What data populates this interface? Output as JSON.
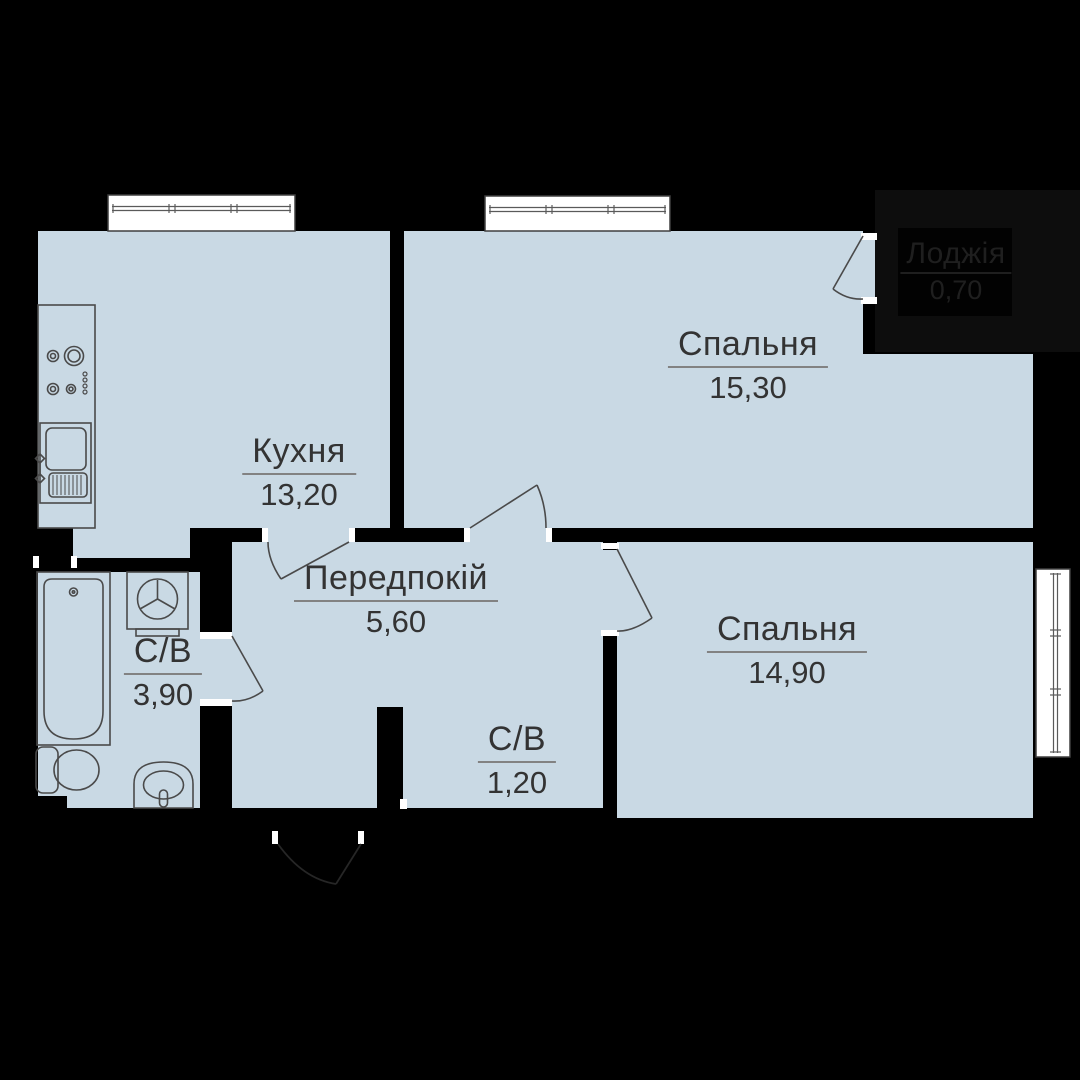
{
  "title": "Apartment floor plan (2-room)",
  "rooms": [
    {
      "key": "kitchen",
      "name": "Кухня",
      "area": "13,20"
    },
    {
      "key": "bedroom-1",
      "name": "Спальня",
      "area": "15,30"
    },
    {
      "key": "hallway",
      "name": "Передпокій",
      "area": "5,60"
    },
    {
      "key": "bathroom",
      "name": "С/В",
      "area": "3,90"
    },
    {
      "key": "wc",
      "name": "С/В",
      "area": "1,20"
    },
    {
      "key": "bedroom-2",
      "name": "Спальня",
      "area": "14,90"
    },
    {
      "key": "loggia",
      "name": "Лоджія",
      "area": "0,70"
    }
  ],
  "fixtures": [
    "stove-icon",
    "kitchen-sink-icon",
    "washing-machine-icon",
    "bathtub-icon",
    "toilet-icon",
    "washbasin-icon"
  ],
  "colors": {
    "background": "#000000",
    "floor_fill": "#c9d9e4",
    "fixture_line": "#4a4a4a",
    "window_fill": "#ffffff",
    "label_text": "#333333",
    "label_underline": "#828282",
    "loggia_fill": "#0d0d0d",
    "loggia_text": "#1f1f1f"
  }
}
